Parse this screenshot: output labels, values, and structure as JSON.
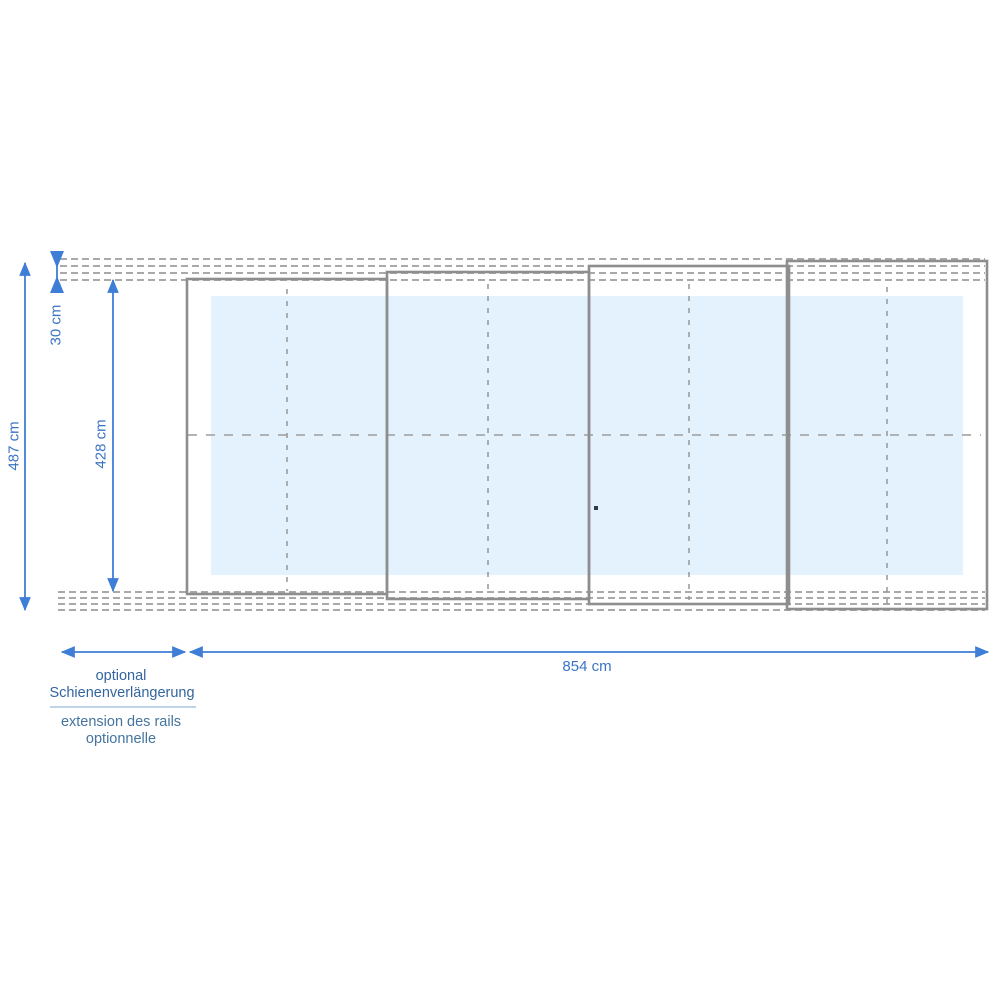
{
  "diagram": {
    "kind": "technical dimension drawing, plan view of 4-panel telescopic enclosure on guide rails",
    "panel_count": 4,
    "dimensions": {
      "overall_height": "487 cm",
      "rail_offset_top": "30 cm",
      "enclosure_height": "428 cm",
      "overall_length": "854 cm"
    },
    "annotations": {
      "rail_extension_de": [
        "optional",
        "Schienenverlängerung"
      ],
      "rail_extension_fr": [
        "extension des rails",
        "optionnelle"
      ]
    },
    "colors": {
      "dimension_blue": "#3e7ed6",
      "dimension_label_blue": "#3b74c4",
      "note_german_blue": "#33659e",
      "note_french_blue": "#44749f",
      "note_divider_blue": "#aac6e2",
      "panel_border_gray": "#8e8e8e",
      "rail_gray": "#a9a9a9",
      "guide_gray": "#9c9c9c",
      "pool_fill": "#e3f2fc",
      "background": "#ffffff"
    }
  }
}
